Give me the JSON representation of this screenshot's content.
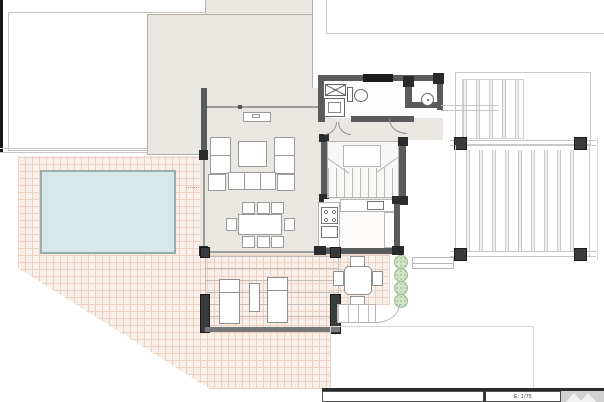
{
  "drawing": {
    "kind": "architectural floor plan",
    "features": [
      "pool",
      "tiled-terrace",
      "pergola-with-loungers",
      "living-room",
      "dining-area",
      "kitchen",
      "bathroom",
      "stairs",
      "outdoor-dining-patio",
      "shrubs",
      "slatted-deck",
      "carport"
    ]
  },
  "title_block": {
    "scale_label": "E: 1/75"
  },
  "icons": {
    "shaft": "x-cross-box",
    "bushes": "dotted-green-circle",
    "logo": "twin-triangles"
  },
  "colors": {
    "pool_fill": "#d6e8e7",
    "pool_border": "#96aeac",
    "tile_bg": "#f9efe9",
    "tile_line": "#ecd0c2",
    "roof_fill": "#eae7e3",
    "wall": "#5a5b5d",
    "column": "#2a2b2d",
    "bush_fill": "#d3e3c8",
    "bush_border": "#9dbb90",
    "dark_bar": "#2b2b2b"
  }
}
